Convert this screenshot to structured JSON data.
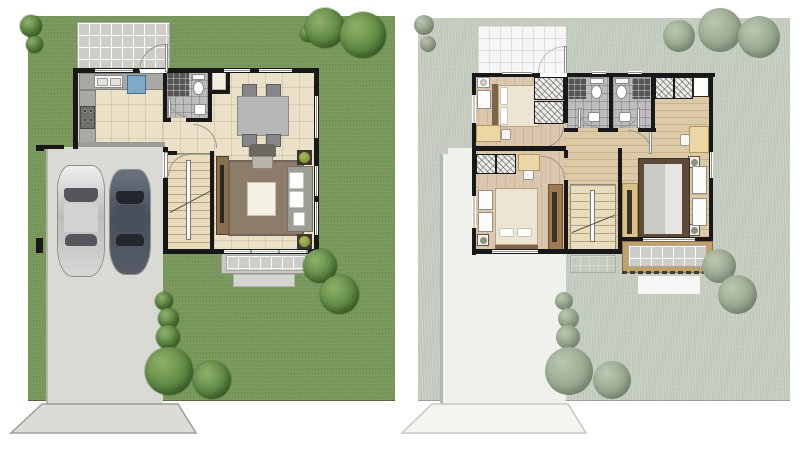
{
  "palette": {
    "background": "#ffffff",
    "grass": "#79995c",
    "grass_faded": "#c7cec2",
    "concrete": "#dadad5",
    "concrete_faded": "#f0f0ec",
    "wall": "#181818",
    "floor_tile": "#eae1c8",
    "wood_floor": "#dcc9a6",
    "bedroom_floor": "#dbc6ae",
    "bathroom_tile": "#bcbcbc",
    "tree": "#5f8a44",
    "tree_faded": "#9aa992",
    "rug": "#8d7c69",
    "balcony_wood": "#c2a069",
    "appliance_blue": "#7fa9c9",
    "car_silver": "#d9d9d7",
    "car_dark": "#59606c"
  },
  "plans": [
    {
      "name": "ground-floor",
      "rooms": [
        "patio",
        "kitchen",
        "bathroom",
        "dining-area",
        "living-room",
        "entry-hall",
        "staircase",
        "carport",
        "terrace",
        "driveway",
        "garden"
      ],
      "objects": [
        "kitchen-sink",
        "stove",
        "blue-appliance",
        "dining-table",
        "dining-chairs-4",
        "sofa",
        "armchair",
        "coffee-table",
        "area-rug",
        "tv-cabinet",
        "potted-plants-2",
        "toilet",
        "shower",
        "washbasin",
        "silver-car",
        "dark-car",
        "garden-trees"
      ]
    },
    {
      "name": "upper-floor",
      "rooms": [
        "front-bedroom",
        "rear-bedroom",
        "master-bedroom",
        "bathroom-1",
        "bathroom-2",
        "hallway",
        "staircase",
        "balcony",
        "roof-terrace"
      ],
      "objects": [
        "double-beds-3",
        "wardrobes",
        "desks-3",
        "nightstands",
        "toilets-2",
        "showers-2",
        "washbasins-2",
        "tv-dresser",
        "potted-plants",
        "faded-garden-trees"
      ]
    }
  ]
}
